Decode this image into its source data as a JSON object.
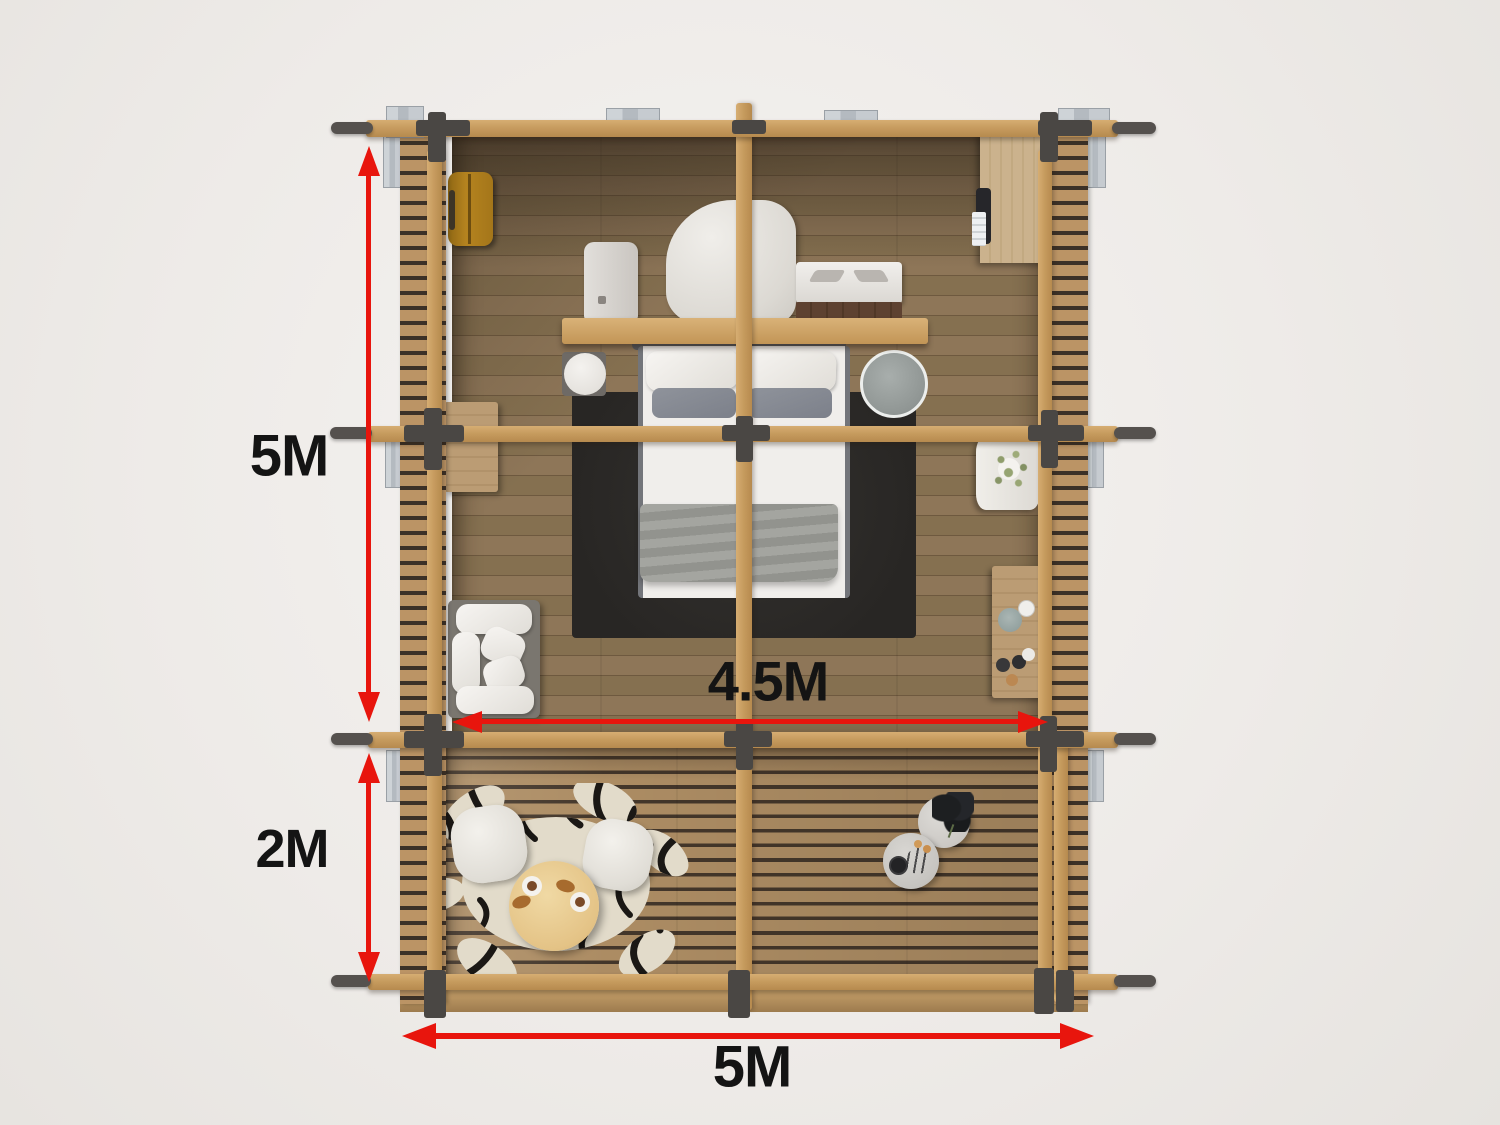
{
  "scene": {
    "type": "top-view 3D cabin floor plan render",
    "areas": [
      "bedroom",
      "deck-terrace"
    ]
  },
  "dimensions": {
    "room_depth": {
      "label": "5M",
      "orientation": "vertical"
    },
    "deck_depth": {
      "label": "2M",
      "orientation": "vertical"
    },
    "interior_width": {
      "label": "4.5M",
      "orientation": "horizontal"
    },
    "total_width": {
      "label": "5M",
      "orientation": "horizontal"
    }
  },
  "furniture": {
    "bedroom": [
      "suitcase",
      "wardrobe",
      "desk-shelf",
      "monitor",
      "desk-chair",
      "typewriter",
      "double-bed",
      "black-area-rug",
      "nightstand-round-white",
      "nightstand-round-gray",
      "side-table-wood",
      "lounge-sofa",
      "plant-stand",
      "console-table"
    ],
    "deck": [
      "zebra-hide-rug",
      "round-coffee-table",
      "deck-chair",
      "deck-chair",
      "marble-side-table-plant",
      "marble-side-table-tray"
    ]
  },
  "colors": {
    "accent_red": "#e8150d",
    "label_black": "#141414",
    "background_gray": "#efece9",
    "beam_wood": "#c79c5f",
    "beam_cap": "#55514e",
    "connector": "#4a4744",
    "slat_wood": "#bb9465",
    "slat_gap": "#3c3127",
    "room_floor_brown": "#8a7254",
    "deck_floor_tan": "#ac8c63",
    "rug_black": "#2c2a28",
    "bed_white": "#f0eeeb",
    "blanket_gray": "#9b9c97",
    "pillow_gray": "#878b93",
    "metal_silver": "#c2c7cc",
    "suitcase_mustard": "#b1821f",
    "wardrobe_wood": "#c9b18c",
    "zebra_cream": "#e2dbca",
    "zebra_black": "#1b1815",
    "deck_table_wood": "#e7c98e",
    "marble_gray": "#d2d0cc",
    "plant_green": "#86955f"
  }
}
